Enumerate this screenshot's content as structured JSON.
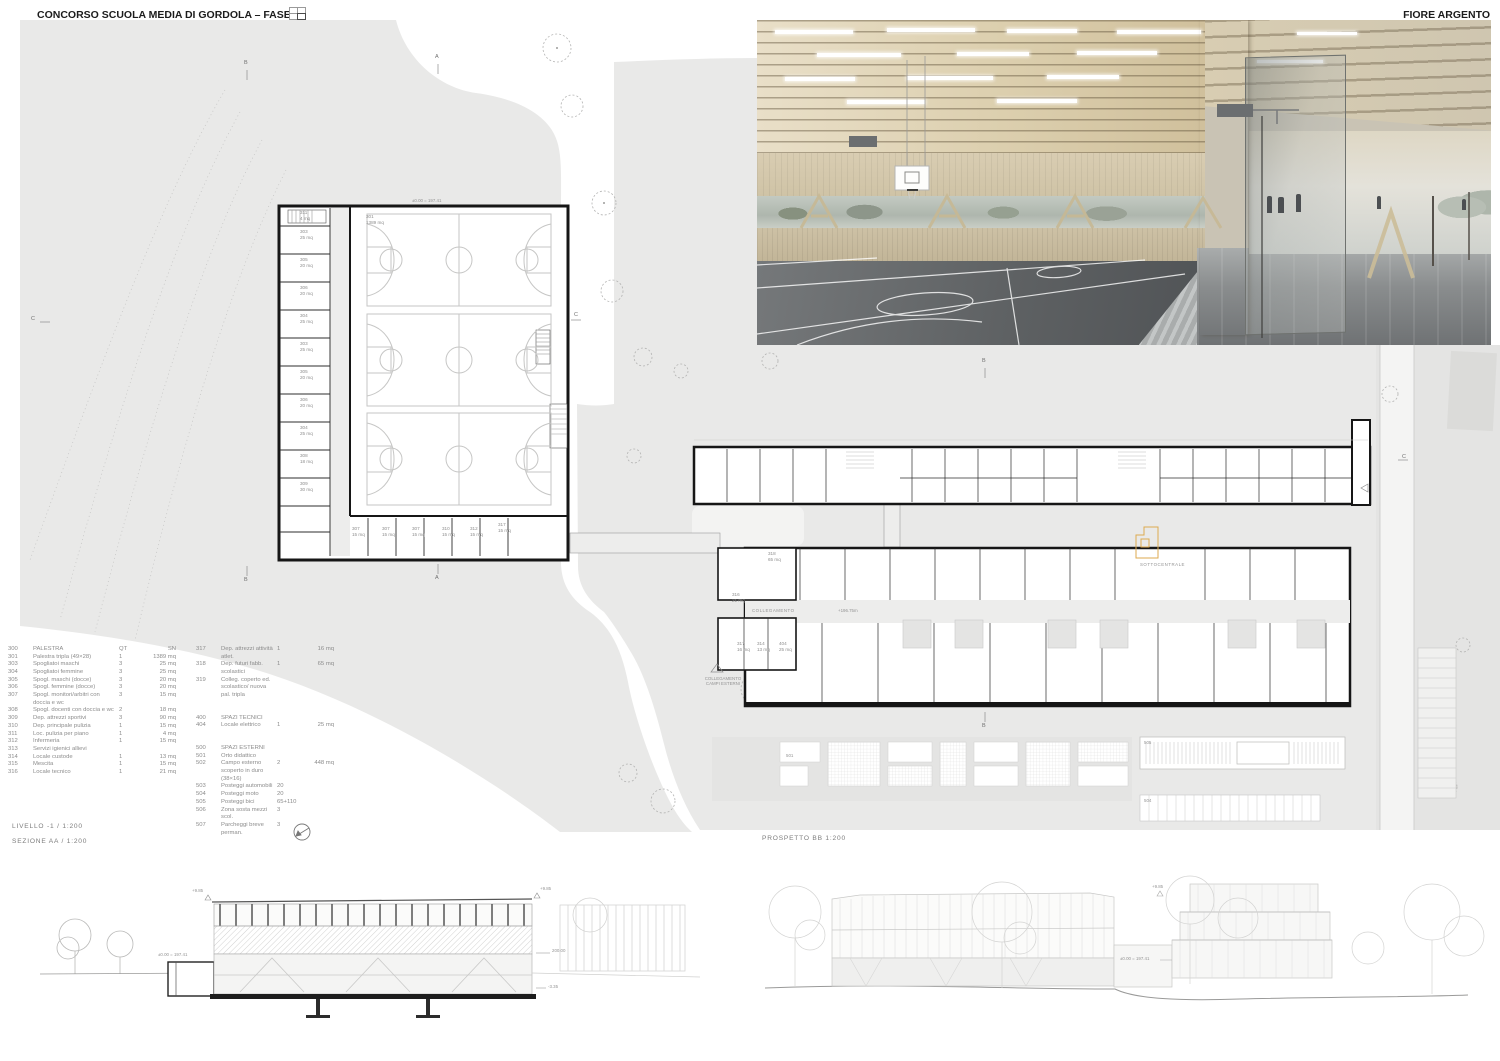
{
  "header": {
    "title": "CONCORSO SCUOLA MEDIA DI GORDOLA – FASE 2",
    "author": "FIORE ARGENTO"
  },
  "views": {
    "livello": "LIVELLO -1 / 1:200",
    "sezione": "SEZIONE AA / 1:200",
    "prospetto": "PROSPETTO BB 1:200"
  },
  "plan": {
    "hall_number": "301",
    "hall_area": "1389 mq",
    "hall_quota": "±0.00 = 197.41",
    "sottocentrale": "SOTTOCENTRALE",
    "collegamento": "COLLEGAMENTO",
    "collegamento_quota": "+196.75m",
    "campi_esterni": "COLLEGAMENTO\nCAMPI ESTERNI",
    "marker_a": "A",
    "marker_b": "B",
    "marker_c": "C",
    "garden": "501",
    "bikes": "505",
    "moto": "504",
    "gym_rooms": [
      {
        "x": 300,
        "y": 210,
        "t": "311\n4 mq"
      },
      {
        "x": 300,
        "y": 229,
        "t": "303\n25 mq"
      },
      {
        "x": 300,
        "y": 257,
        "t": "305\n20 mq"
      },
      {
        "x": 300,
        "y": 285,
        "t": "306\n20 mq"
      },
      {
        "x": 300,
        "y": 313,
        "t": "304\n25 mq"
      },
      {
        "x": 300,
        "y": 341,
        "t": "303\n25 mq"
      },
      {
        "x": 300,
        "y": 369,
        "t": "305\n20 mq"
      },
      {
        "x": 300,
        "y": 397,
        "t": "306\n20 mq"
      },
      {
        "x": 300,
        "y": 425,
        "t": "304\n25 mq"
      },
      {
        "x": 300,
        "y": 453,
        "t": "308\n18 mq"
      },
      {
        "x": 300,
        "y": 481,
        "t": "309\n30 mq"
      }
    ],
    "strip_rooms": [
      {
        "x": 352,
        "y": 526,
        "t": "307\n15 mq"
      },
      {
        "x": 382,
        "y": 526,
        "t": "307\n15 mq"
      },
      {
        "x": 412,
        "y": 526,
        "t": "307\n15 mq"
      },
      {
        "x": 442,
        "y": 526,
        "t": "310\n15 mq"
      },
      {
        "x": 470,
        "y": 526,
        "t": "312\n15 mq"
      },
      {
        "x": 498,
        "y": 522,
        "t": "317\n15 mq"
      }
    ],
    "annex_rooms": [
      {
        "x": 737,
        "y": 641,
        "t": "317\n16 mq"
      },
      {
        "x": 757,
        "y": 641,
        "t": "314\n13 mq"
      },
      {
        "x": 779,
        "y": 641,
        "t": "404\n25 mq"
      },
      {
        "x": 768,
        "y": 551,
        "t": "318\n65 mq"
      },
      {
        "x": 732,
        "y": 592,
        "t": "316\n21 mq"
      }
    ]
  },
  "levels": {
    "top": "+9.85",
    "zero": "±0.00 = 197.41",
    "right": "200.00",
    "bottom": "-3.35"
  },
  "legend": {
    "col1": [
      {
        "num": "300",
        "label": "PALESTRA",
        "qt": "QT",
        "area": "SN"
      },
      {
        "num": "301",
        "label": "Palestra tripla (49×28)",
        "qt": "1",
        "area": "1389 mq"
      },
      {
        "num": "303",
        "label": "Spogliatoi maschi",
        "qt": "3",
        "area": "25 mq"
      },
      {
        "num": "304",
        "label": "Spogliatoi femmine",
        "qt": "3",
        "area": "25 mq"
      },
      {
        "num": "305",
        "label": "Spogl. maschi (docce)",
        "qt": "3",
        "area": "20 mq"
      },
      {
        "num": "306",
        "label": "Spogl. femmine (docce)",
        "qt": "3",
        "area": "20 mq"
      },
      {
        "num": "307",
        "label": "Spogl. monitori/arbitri con doccia e wc",
        "qt": "3",
        "area": "15 mq"
      },
      {
        "num": "308",
        "label": "Spogl. docenti con doccia e wc",
        "qt": "2",
        "area": "18 mq"
      },
      {
        "num": "309",
        "label": "Dep. attrezzi sportivi",
        "qt": "3",
        "area": "90 mq"
      },
      {
        "num": "310",
        "label": "Dep. principale pulizia",
        "qt": "1",
        "area": "15 mq"
      },
      {
        "num": "311",
        "label": "Loc. pulizia per piano",
        "qt": "1",
        "area": "4 mq"
      },
      {
        "num": "312",
        "label": "Infermeria",
        "qt": "1",
        "area": "15 mq"
      },
      {
        "num": "313",
        "label": "Servizi igienici allievi",
        "qt": "",
        "area": ""
      },
      {
        "num": "314",
        "label": "Locale custode",
        "qt": "1",
        "area": "13 mq"
      },
      {
        "num": "315",
        "label": "Mescita",
        "qt": "1",
        "area": "15 mq"
      },
      {
        "num": "316",
        "label": "Locale tecnico",
        "qt": "1",
        "area": "21 mq"
      }
    ],
    "col2": [
      {
        "num": "317",
        "label": "Dep. attrezzi attività atlet.",
        "qt": "1",
        "area": "16 mq"
      },
      {
        "num": "318",
        "label": "Dep. futuri fabb. scolastici",
        "qt": "1",
        "area": "65 mq"
      },
      {
        "num": "319",
        "label": "Colleg. coperto ed. scolastico/ nuova pal. tripla",
        "qt": "",
        "area": ""
      },
      {
        "spacer": true
      },
      {
        "num": "400",
        "label": "SPAZI TECNICI",
        "qt": "",
        "area": ""
      },
      {
        "num": "404",
        "label": "Locale elettrico",
        "qt": "1",
        "area": "25 mq"
      },
      {
        "spacer": true
      },
      {
        "num": "500",
        "label": "SPAZI ESTERNI",
        "qt": "",
        "area": ""
      },
      {
        "num": "501",
        "label": "Orto didattico",
        "qt": "",
        "area": ""
      },
      {
        "num": "502",
        "label": "Campo esterno scoperto in duro (38×16)",
        "qt": "2",
        "area": "448 mq"
      },
      {
        "num": "503",
        "label": "Posteggi automobili",
        "qt": "20",
        "area": ""
      },
      {
        "num": "504",
        "label": "Posteggi moto",
        "qt": "20",
        "area": ""
      },
      {
        "num": "505",
        "label": "Posteggi bici",
        "qt": "65+110",
        "area": ""
      },
      {
        "num": "506",
        "label": "Zona sosta mezzi scol.",
        "qt": "3",
        "area": ""
      },
      {
        "num": "507",
        "label": "Parcheggi breve perman.",
        "qt": "3",
        "area": ""
      }
    ]
  },
  "colors": {
    "terrain": "#e9e9e8",
    "wall": "#161616",
    "accent": "#ddaa4f",
    "court": "#c6c6c5"
  }
}
